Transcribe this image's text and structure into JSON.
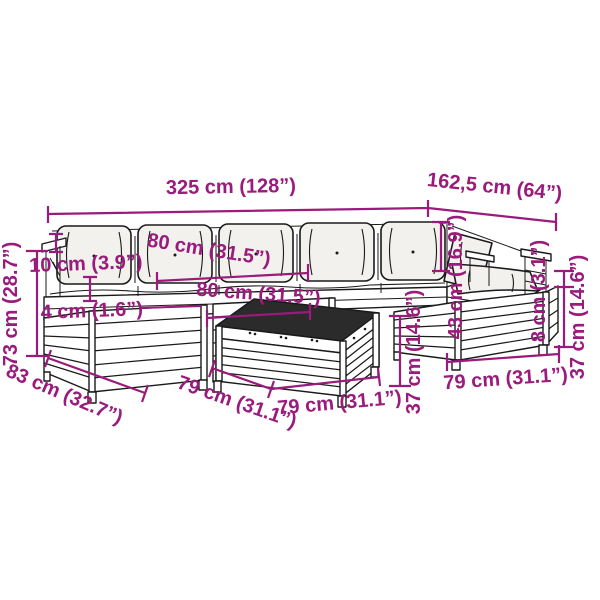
{
  "figure": {
    "type": "product-dimension-diagram",
    "subject": "wooden-garden-lounge-set-line-drawing",
    "background_color": "#ffffff",
    "line_color": "#1a1a1a",
    "accent_color": "#9a1b7c",
    "cushion_color": "#f2f1ee",
    "table_top_color": "#2b2b2b"
  },
  "dimensions": {
    "overall_width": {
      "label": "325 cm (128”)"
    },
    "right_section_width": {
      "label": "162,5 cm (64”)"
    },
    "back_cushion_width": {
      "label": "80 cm (31.5”)"
    },
    "seat_module_width": {
      "label": "80 cm (31.5”)"
    },
    "armrest_offset": {
      "label": "10 cm (3.9”)"
    },
    "frame_gap": {
      "label": "4 cm (1.6”)"
    },
    "overall_height": {
      "label": "73 cm (28.7”)"
    },
    "module_depth": {
      "label": "83 cm (32.7”)"
    },
    "table_depth": {
      "label": "79 cm (31.1”)"
    },
    "table_width": {
      "label": "79 cm (31.1”)"
    },
    "ottoman_width": {
      "label": "79 cm (31.1”)"
    },
    "table_height": {
      "label": "37 cm (14.6”)"
    },
    "seat_height": {
      "label": "37 cm (14.6”)"
    },
    "cushion_thickness": {
      "label": "8 cm (3.1”)"
    },
    "backrest_height": {
      "label": "43 cm (16.9”)"
    }
  }
}
